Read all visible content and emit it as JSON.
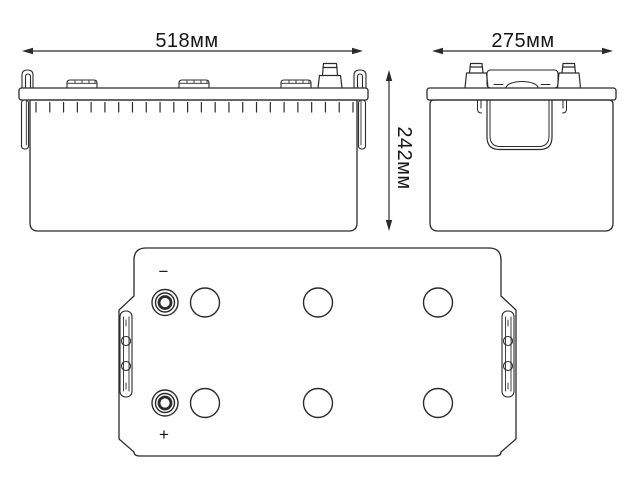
{
  "drawing": {
    "subject": "battery-dimensional-drawing",
    "colors": {
      "background": "#ffffff",
      "line": "#2b2b2b",
      "text": "#161616"
    },
    "dimensions": {
      "front_width": "518мм",
      "side_width": "275мм",
      "height": "242мм"
    },
    "terminals": {
      "negative": "−",
      "positive": "+"
    },
    "views": {
      "front": {
        "vent_cap_count": 3,
        "rib_count": 24
      },
      "side": {
        "post_count": 2,
        "handle_count": 1
      },
      "top": {
        "vent_rows": 2,
        "vents_per_row": 3,
        "terminal_count": 2,
        "handle_bar_count": 2
      }
    }
  }
}
